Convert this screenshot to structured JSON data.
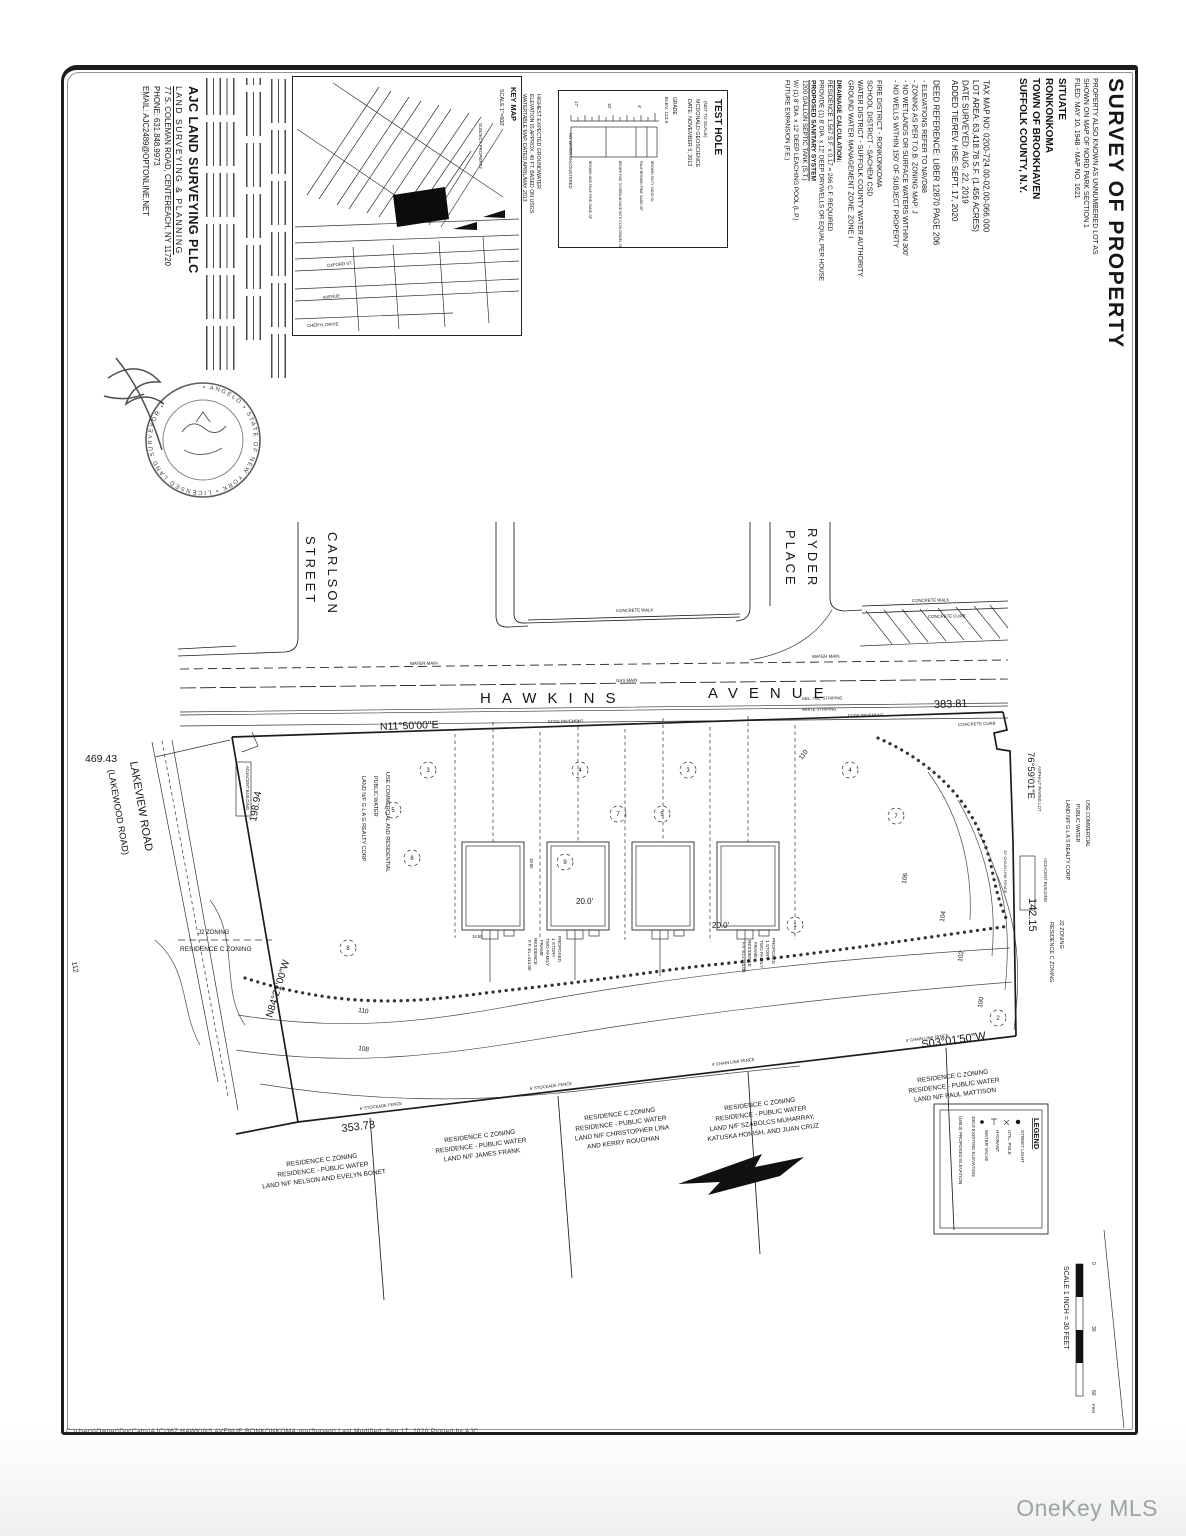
{
  "watermark": "OneKey MLS",
  "titleblock": {
    "title": "SURVEY OF PROPERTY",
    "aka1": "PROPERTY ALSO KNOWN AS UNNUMBERED LOT AS",
    "aka2": "SHOWN ON MAP OF NORD PARK SECTION 1",
    "aka3": "FILED: MAY 10, 1948 - MAP NO. 1621",
    "situate": "SITUATE",
    "hamlet": "RONKONKOMA",
    "town": "TOWN OF BROOKHAVEN",
    "county": "SUFFOLK COUNTY, N.Y.",
    "tax1": "TAX MAP NO: 0200-724.00-02.00-066.000",
    "tax2": "LOT AREA: 63,418.78 S.F. (1.456 ACRES)",
    "tax3": "DATE SURVEYED: AUG. 22, 2019",
    "tax4": "ADDED TIE/REV. HSE: SEPT. 17, 2020",
    "deed": "DEED REFERENCE: LIBER 12870 PAGE 206"
  },
  "notes": {
    "b1": "- ELEVATIONS REFER TO NAVD88",
    "b2": "- ZONING AS PER T.O.B. ZONING MAP: J",
    "b3": "- NO WETLANDS OR SURFACE WATERS WITHIN 300'",
    "b4": "- NO WELLS WITHIN 150' OF SUBJECT PROPERTY",
    "d1": "FIRE DISTRICT - RONKONKOMA",
    "d2": "SCHOOL DISTRICT - SACHEM CSD",
    "d3": "WATER DISTRICT - SUFFOLK COUNTY WATER AUTHORITY",
    "d4": "GROUND WATER MANAGEMENT ZONE: ZONE I",
    "dr1": "DRAINAGE CALCULATION:",
    "dr2": "RESIDENCE 1,567 S.F. x 0.17 = 266 C.F. REQUIRED",
    "dr3": "PROVIDE (1) 8' DIA. x 12' DEEP DRYWELLS OR EQUAL PER HOUSE",
    "s0": "PROPOSED SANITARY SYSTEM",
    "s1": "1200 GALLON SEPTIC TANK (S.T.)",
    "s2": "W/ (1) 8' DIA. x 12' DEEP LEACHING POOL (L.P.)",
    "s3": "FUTURE EXPANSION (F.E.)"
  },
  "testhole": {
    "title": "TEST HOLE",
    "nts": "(NOT TO SCALE)",
    "firm": "MCDONALD GEOSCIENCE",
    "date": "DATE: NOVEMBER 5, 2013",
    "grade": "GRADE",
    "elev": "ELEV. 113.0",
    "l1": "BROWN SILTY SAND OL",
    "l2": "PALE BROWN FINE SAND SP",
    "l3": "BROWN FINE TO MEDIUM SAND WITH 5-10% GRAVEL SP",
    "l4": "BROWN AND PALE FINE SAND SP",
    "d1": "4'",
    "d2": "10'",
    "d3": "17'",
    "f1": "NO WATER ENCOUNTERED",
    "f2": "HIGHEST EXPECTED GROUNDWATER",
    "f3": "ELEVATION IS APPROX. 40 FT. BASED ON USGS",
    "f4": "WATERTABLE MAP, DATED APRIL/MAY 2013"
  },
  "keymap": {
    "title": "KEY MAP",
    "scale": "SCALE 1\"=600'",
    "subject": "SUBJECT PROPERTY",
    "st1": "OXFORD ST.",
    "st2": "AVENUE",
    "st3": "CHERYL DRIVE"
  },
  "firm": {
    "name": "AJC LAND SURVEYING PLLC",
    "tag": "LAND SURVEYING & PLANNING",
    "addr": "77 S. COLEMAN ROAD, CENTEREACH, NY 11720",
    "phone": "PHONE: 631.848.9973",
    "email": "EMAIL: AJC2489@OPTONLINE.NET",
    "seal": "• ANGELO •  STATE OF NEW YORK  • LICENSED LAND SURVEYOR •"
  },
  "map": {
    "carlson1": "CARLSON",
    "carlson2": "STREET",
    "ryder1": "RYDER",
    "ryder2": "PLACE",
    "hawkins1": "HAWKINS",
    "hawkins2": "AVENUE",
    "lakeview1": "LAKEVIEW   ROAD",
    "lakeview2": "(LAKEWOOD   ROAD)",
    "b_north": "N11°50'00\"E",
    "b_east": "76°59'01\"E",
    "b_sw": "N84°21'00\"W",
    "b_se": "S03°01'50\"W",
    "d_north": "383.81",
    "d_tie": "469.43",
    "d_west": "198.94",
    "d_east": "142.15",
    "d_south": "353.73",
    "cw": "CONCRETE WALK",
    "cc": "CONCRETE CURB",
    "wm": "WATER MAIN",
    "gm": "GAS MAIN",
    "dy": "DBL. YEL. STRIPING",
    "ws": "WHITE STRIPING",
    "ep": "EDGE PAVEMENT",
    "c100": "100",
    "c102": "102",
    "c104": "104",
    "c106": "106",
    "c108": "108",
    "c110": "110",
    "c112": "112",
    "h1": "PROPOSED",
    "h2": "1 STORY",
    "h3": "TWO FAMILY",
    "h4": "FRAME",
    "h5": "RESIDENCE",
    "h6": "F.F. EL=114.00",
    "dim20": "20.0'",
    "dimA": "18.00",
    "dimB": "14.50",
    "zl1": "J2 ZONING",
    "zl2": "RESIDENCE C ZONING",
    "adj": "ADJACENT BUILDING",
    "apl": "ASPHALT PAVING LOT",
    "clf10": "10' CHAIN LINK FENCE",
    "ul1": "USE COMMERCIAL AND RESIDENTIAL",
    "ul2": "PUBLIC WATER",
    "ul3": "LAND N/F G L A G REALTY CORP",
    "ur1": "USE COMMERCIAL",
    "ur2": "PUBLIC WATER",
    "ur3": "LAND N/F G L A S REALTY CORP",
    "n1a": "RESIDENCE C ZONING",
    "n1b": "RESIDENCE - PUBLIC WATER",
    "n1c": "LAND N/F NELSON AND EVELYN BONET",
    "n2c": "LAND N/F JAMES FRANK",
    "n3c": "LAND N/F CHRISTOPHER LINA",
    "n3d": "AND KERRY ROUGHAN",
    "n4c": "LAND N/F SZABOLCS MUHARRAY,",
    "n4d": "KATUSKA HONISH, AND JUAN CRUZ",
    "n5c": "LAND N/F PAUL MATTISON",
    "f6": "6' STOCKADE FENCE",
    "f4": "4' CHAIN LINK FENCE",
    "leg": "LEGEND",
    "le1": "STREET LIGHT",
    "le2": "UTIL. POLE",
    "le3": "HYDRANT",
    "le4": "WATER VALVE",
    "le5": "100.0  EXISTING ELEVATION",
    "le6": "(100.0)  PROPOSED ELEVATION",
    "sc": "SCALE 1 INCH = 30 FEET",
    "sc0": "0",
    "sc30": "30",
    "sc60": "60",
    "scu": "Feet",
    "m1": "3",
    "m2": "5",
    "m3": "8",
    "m4": "4",
    "m5": "7",
    "m6": "9",
    "m7": "1",
    "m8": "2"
  },
  "footer": "C:\\Users\\Owner\\DocCabs\\AJC\\367 HAWKINS AVENUE RONKONKOMA.pro(Survey)   Last Modified: Sep 17, 2020   Plotted by AJC"
}
